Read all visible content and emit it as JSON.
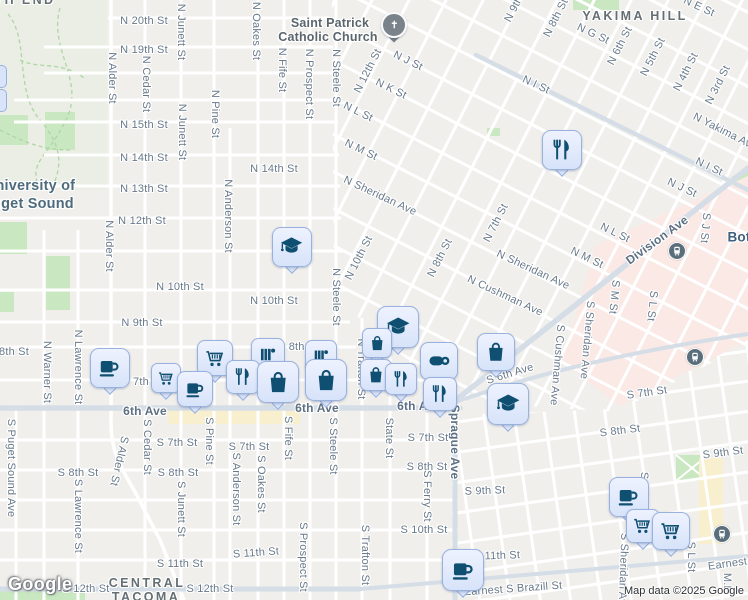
{
  "attribution": {
    "logo_label": "Google",
    "copyright": "Map data ©2025 Google"
  },
  "colors": {
    "land": "#f0efec",
    "road_minor": "#ffffff",
    "road_major": "#d5dde7",
    "park": "#c9e8c1",
    "campus": "#eaeee4",
    "medical_area": "#fae9e5",
    "commercial_area": "#f7efce",
    "pin_fill": "#d9e4fa",
    "pin_border": "#99b1de",
    "pin_glyph": "#0f4f71",
    "church_pin": "#7a828a",
    "transit_badge": "#5b6e7c",
    "street_label": "#68798a"
  },
  "map": {
    "labels": [
      {
        "t": "TH END",
        "x": 25,
        "y": 0,
        "c": "area"
      },
      {
        "t": "YAKIMA HILL",
        "x": 635,
        "y": 16,
        "c": "area"
      },
      {
        "t": "CENTRAL",
        "x": 147,
        "y": 583,
        "c": "area"
      },
      {
        "t": "TACOMA",
        "x": 146,
        "y": 597,
        "c": "area"
      },
      {
        "t": "University of",
        "x": 30,
        "y": 186,
        "c": "college"
      },
      {
        "t": "Puget Sound",
        "x": 28,
        "y": 204,
        "c": "college"
      },
      {
        "t": "Saint Patrick",
        "x": 330,
        "y": 23,
        "c": "poi"
      },
      {
        "t": "Catholic Church",
        "x": 328,
        "y": 37,
        "c": "poi"
      },
      {
        "t": "Bot",
        "x": 739,
        "y": 237,
        "c": "locality"
      },
      {
        "t": "6th Ave",
        "x": 145,
        "y": 411,
        "c": "art"
      },
      {
        "t": "6th Ave",
        "x": 317,
        "y": 408,
        "c": "art"
      },
      {
        "t": "6th Ave",
        "x": 419,
        "y": 406,
        "c": "art"
      },
      {
        "t": "Division Ave",
        "x": 657,
        "y": 240,
        "r": -36,
        "c": "art"
      },
      {
        "t": "Sprague Ave",
        "x": 455,
        "y": 442,
        "r": 90,
        "c": "art"
      },
      {
        "t": "N 20th St",
        "x": 144,
        "y": 21
      },
      {
        "t": "N 19th St",
        "x": 144,
        "y": 50
      },
      {
        "t": "N 15th St",
        "x": 144,
        "y": 125
      },
      {
        "t": "N 14th St",
        "x": 144,
        "y": 158
      },
      {
        "t": "N 14th St",
        "x": 274,
        "y": 169
      },
      {
        "t": "N 13th St",
        "x": 144,
        "y": 189
      },
      {
        "t": "N 12th St",
        "x": 142,
        "y": 221
      },
      {
        "t": "N 10th St",
        "x": 180,
        "y": 287
      },
      {
        "t": "N 10th St",
        "x": 274,
        "y": 301
      },
      {
        "t": "N 9th St",
        "x": 142,
        "y": 323
      },
      {
        "t": "8th St",
        "x": 14,
        "y": 352
      },
      {
        "t": "N 8th St",
        "x": 298,
        "y": 347
      },
      {
        "t": "7th",
        "x": 141,
        "y": 382
      },
      {
        "t": "S 7th St",
        "x": 177,
        "y": 443
      },
      {
        "t": "S 7th St",
        "x": 249,
        "y": 447
      },
      {
        "t": "S 7th St",
        "x": 428,
        "y": 438
      },
      {
        "t": "S 7th St",
        "x": 647,
        "y": 393,
        "r": -8
      },
      {
        "t": "S 8th St",
        "x": 78,
        "y": 473
      },
      {
        "t": "S 8th St",
        "x": 178,
        "y": 473
      },
      {
        "t": "S 8th St",
        "x": 427,
        "y": 467
      },
      {
        "t": "S 8th St",
        "x": 620,
        "y": 431,
        "r": -7
      },
      {
        "t": "S 9th St",
        "x": 485,
        "y": 491,
        "r": -2
      },
      {
        "t": "S 9th St",
        "x": 723,
        "y": 453,
        "r": -7
      },
      {
        "t": "S 10th St",
        "x": 424,
        "y": 530
      },
      {
        "t": "S 11th St",
        "x": 180,
        "y": 564
      },
      {
        "t": "S 11th St",
        "x": 256,
        "y": 553,
        "r": -4
      },
      {
        "t": "S 11th St",
        "x": 497,
        "y": 556,
        "r": -2
      },
      {
        "t": "S 12th St",
        "x": 86,
        "y": 589
      },
      {
        "t": "S 12th St",
        "x": 210,
        "y": 589
      },
      {
        "t": "Earnest S Brazill St",
        "x": 513,
        "y": 589,
        "r": -4
      },
      {
        "t": "Earnest S Brazill St",
        "x": 757,
        "y": 560,
        "r": -8
      },
      {
        "t": "M.L.",
        "x": 727,
        "y": 584,
        "r": 90
      },
      {
        "t": "N Alder St",
        "x": 112,
        "y": 78,
        "r": 90
      },
      {
        "t": "N Alder St",
        "x": 109,
        "y": 246,
        "r": 90
      },
      {
        "t": "N Cedar St",
        "x": 146,
        "y": 84,
        "r": 90
      },
      {
        "t": "N Junett St",
        "x": 181,
        "y": 32,
        "r": 90
      },
      {
        "t": "N Junett St",
        "x": 182,
        "y": 132,
        "r": 90
      },
      {
        "t": "N Pine St",
        "x": 215,
        "y": 114,
        "r": 90
      },
      {
        "t": "N Oakes St",
        "x": 256,
        "y": 31,
        "r": 90
      },
      {
        "t": "N Fife St",
        "x": 282,
        "y": 70,
        "r": 90
      },
      {
        "t": "N Prospect St",
        "x": 309,
        "y": 84,
        "r": 90
      },
      {
        "t": "N Steele St",
        "x": 336,
        "y": 78,
        "r": 90
      },
      {
        "t": "N Steele St",
        "x": 336,
        "y": 297,
        "r": 90
      },
      {
        "t": "N Anderson St",
        "x": 228,
        "y": 216,
        "r": 90
      },
      {
        "t": "N Warner St",
        "x": 47,
        "y": 372,
        "r": 90
      },
      {
        "t": "N Lawrence St",
        "x": 78,
        "y": 367,
        "r": 90
      },
      {
        "t": "N Trafton St",
        "x": 361,
        "y": 369,
        "r": 90
      },
      {
        "t": "S Puget Sound Ave",
        "x": 11,
        "y": 468,
        "r": 90
      },
      {
        "t": "S Alder St",
        "x": 119,
        "y": 461,
        "r": 103
      },
      {
        "t": "S Cedar St",
        "x": 147,
        "y": 447,
        "r": 90
      },
      {
        "t": "S Lawrence St",
        "x": 78,
        "y": 516,
        "r": 90
      },
      {
        "t": "S Junett St",
        "x": 181,
        "y": 509,
        "r": 90
      },
      {
        "t": "S Pine St",
        "x": 209,
        "y": 441,
        "r": 90
      },
      {
        "t": "S Anderson St",
        "x": 236,
        "y": 489,
        "r": 90
      },
      {
        "t": "S Oakes St",
        "x": 261,
        "y": 484,
        "r": 90
      },
      {
        "t": "S Fife St",
        "x": 288,
        "y": 438,
        "r": 90
      },
      {
        "t": "S Steele St",
        "x": 333,
        "y": 446,
        "r": 90
      },
      {
        "t": "S Prospect St",
        "x": 303,
        "y": 557,
        "r": 90
      },
      {
        "t": "S Trafton St",
        "x": 365,
        "y": 555,
        "r": 90
      },
      {
        "t": "State St",
        "x": 389,
        "y": 438,
        "r": 90
      },
      {
        "t": "S Ferry St",
        "x": 427,
        "y": 496,
        "r": 90
      },
      {
        "t": "S Sheridan Ave",
        "x": 623,
        "y": 572,
        "r": 92
      },
      {
        "t": "S Sheridan Ave",
        "x": 587,
        "y": 340,
        "r": 95
      },
      {
        "t": "S Cushman Ave",
        "x": 557,
        "y": 365,
        "r": 95
      },
      {
        "t": "S M St",
        "x": 614,
        "y": 297,
        "r": 96
      },
      {
        "t": "S M St",
        "x": 644,
        "y": 489,
        "r": 90
      },
      {
        "t": "S L St",
        "x": 652,
        "y": 306,
        "r": 96
      },
      {
        "t": "S L St",
        "x": 691,
        "y": 557,
        "r": 90
      },
      {
        "t": "S J St",
        "x": 705,
        "y": 228,
        "r": 95
      },
      {
        "t": "N J St",
        "x": 408,
        "y": 61,
        "r": 26
      },
      {
        "t": "N K St",
        "x": 391,
        "y": 89,
        "r": 26
      },
      {
        "t": "N L St",
        "x": 358,
        "y": 112,
        "r": 26
      },
      {
        "t": "N M St",
        "x": 361,
        "y": 150,
        "r": 26
      },
      {
        "t": "N L St",
        "x": 615,
        "y": 233,
        "r": 26
      },
      {
        "t": "N M St",
        "x": 587,
        "y": 258,
        "r": 26
      },
      {
        "t": "N Sheridan Ave",
        "x": 380,
        "y": 196,
        "r": 25
      },
      {
        "t": "N Sheridan Ave",
        "x": 533,
        "y": 270,
        "r": 25
      },
      {
        "t": "N Cushman Ave",
        "x": 505,
        "y": 296,
        "r": 25
      },
      {
        "t": "N I St",
        "x": 536,
        "y": 85,
        "r": 25
      },
      {
        "t": "N I St",
        "x": 709,
        "y": 167,
        "r": 25
      },
      {
        "t": "N J St",
        "x": 682,
        "y": 188,
        "r": 25
      },
      {
        "t": "N E St",
        "x": 699,
        "y": 7,
        "r": 25
      },
      {
        "t": "N G St",
        "x": 593,
        "y": 34,
        "r": 25
      },
      {
        "t": "N Yakima Ave",
        "x": 725,
        "y": 132,
        "r": 27
      },
      {
        "t": "S 6th Ave",
        "x": 510,
        "y": 374,
        "r": -17
      },
      {
        "t": "N 12th St",
        "x": 368,
        "y": 71,
        "r": -63
      },
      {
        "t": "N 10th St",
        "x": 359,
        "y": 258,
        "r": -63
      },
      {
        "t": "N 8th St",
        "x": 440,
        "y": 258,
        "r": -63
      },
      {
        "t": "N 7th St",
        "x": 496,
        "y": 223,
        "r": -63
      },
      {
        "t": "N 8th St",
        "x": 556,
        "y": 18,
        "r": -63
      },
      {
        "t": "N 6th St",
        "x": 620,
        "y": 46,
        "r": -63
      },
      {
        "t": "N 5th St",
        "x": 653,
        "y": 57,
        "r": -63
      },
      {
        "t": "N 4th St",
        "x": 686,
        "y": 72,
        "r": -63
      },
      {
        "t": "N 3rd St",
        "x": 718,
        "y": 85,
        "r": -63
      },
      {
        "t": "N 9th St",
        "x": 517,
        "y": 3,
        "r": -63
      }
    ],
    "pins": [
      {
        "icon": "church-icon",
        "x": 394,
        "y": 25,
        "s": 26
      },
      {
        "icon": "restaurant-icon",
        "x": 562,
        "y": 150,
        "s": 40
      },
      {
        "icon": "school-icon",
        "x": 292,
        "y": 247,
        "s": 40
      },
      {
        "icon": "school-icon",
        "x": 398,
        "y": 327,
        "s": 42
      },
      {
        "icon": "school-icon",
        "x": 508,
        "y": 404,
        "s": 42
      },
      {
        "icon": "shopping-bag-icon",
        "x": 496,
        "y": 352,
        "s": 38
      },
      {
        "icon": "coffee-icon",
        "x": 110,
        "y": 368,
        "s": 40
      },
      {
        "icon": "cart-icon",
        "x": 166,
        "y": 378,
        "s": 30
      },
      {
        "icon": "coffee-icon",
        "x": 195,
        "y": 389,
        "s": 36
      },
      {
        "icon": "cart-icon",
        "x": 215,
        "y": 358,
        "s": 36
      },
      {
        "icon": "books-icon",
        "x": 268,
        "y": 355,
        "s": 34
      },
      {
        "icon": "restaurant-icon",
        "x": 243,
        "y": 377,
        "s": 34
      },
      {
        "icon": "shopping-bag-icon",
        "x": 278,
        "y": 382,
        "s": 42
      },
      {
        "icon": "books-icon",
        "x": 321,
        "y": 356,
        "s": 32
      },
      {
        "icon": "shopping-bag-icon",
        "x": 326,
        "y": 380,
        "s": 42
      },
      {
        "icon": "shopping-bag-icon",
        "x": 377,
        "y": 343,
        "s": 30
      },
      {
        "icon": "shopping-bag-icon",
        "x": 376,
        "y": 375,
        "s": 32
      },
      {
        "icon": "restaurant-icon",
        "x": 401,
        "y": 379,
        "s": 32
      },
      {
        "icon": "mug-icon",
        "x": 439,
        "y": 361,
        "s": 38
      },
      {
        "icon": "restaurant-icon",
        "x": 440,
        "y": 394,
        "s": 34
      },
      {
        "icon": "coffee-icon",
        "x": 463,
        "y": 570,
        "s": 42
      },
      {
        "icon": "coffee-icon",
        "x": 629,
        "y": 497,
        "s": 40
      },
      {
        "icon": "cart-icon",
        "x": 643,
        "y": 526,
        "s": 34
      },
      {
        "icon": "cart-icon",
        "x": 671,
        "y": 531,
        "s": 38
      }
    ],
    "transit_badges": [
      {
        "x": 676,
        "y": 250
      },
      {
        "x": 694,
        "y": 356
      },
      {
        "x": 721,
        "y": 533
      }
    ],
    "edge_pins": [
      {
        "x": 0,
        "y": 76
      },
      {
        "x": 0,
        "y": 100
      }
    ]
  }
}
